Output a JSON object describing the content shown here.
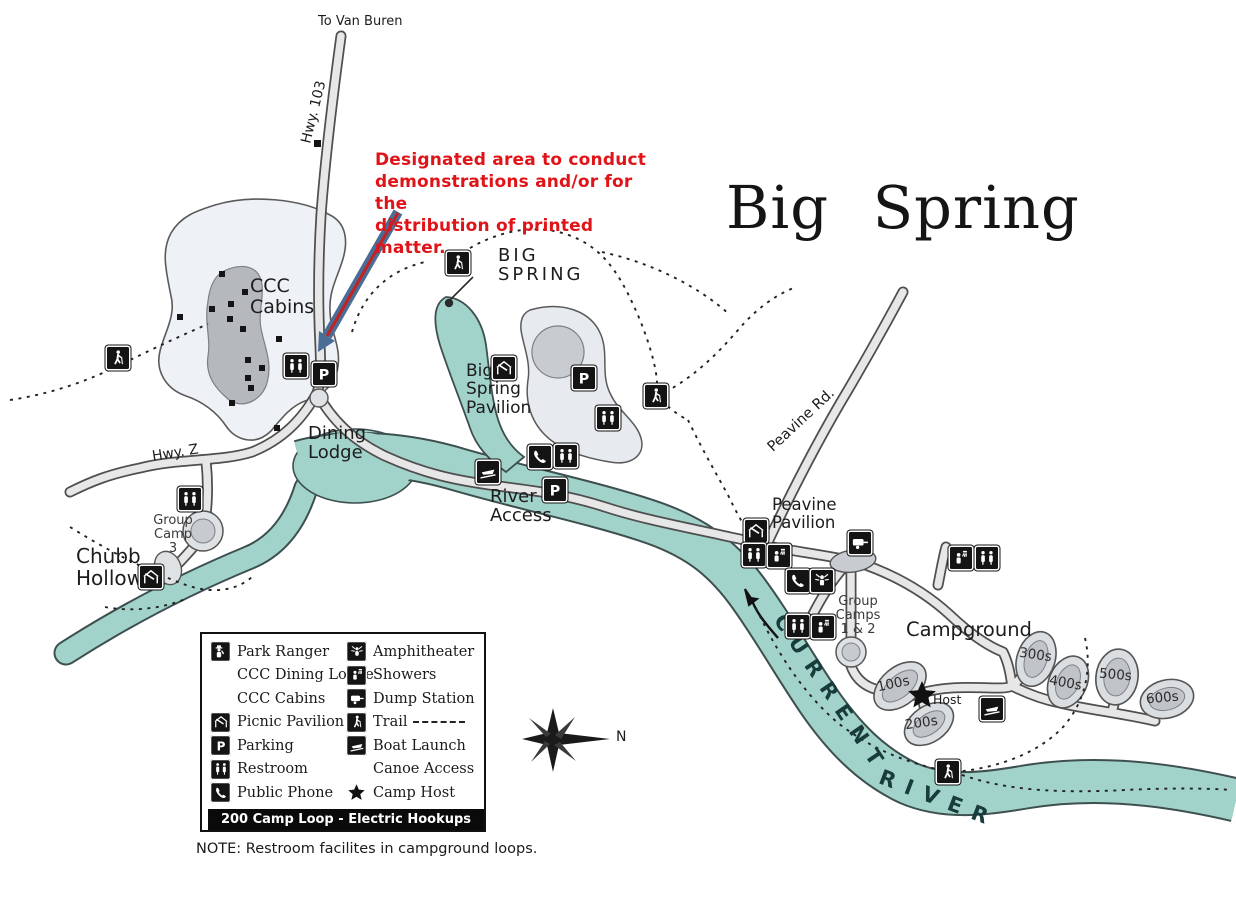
{
  "header": {
    "title": "Big Spring"
  },
  "annotation": {
    "text": "Designated area to conduct\ndemonstrations and/or for the\ndistribution of printed matter.",
    "color": "#e01418"
  },
  "colors": {
    "water": "#a2d3cb",
    "road_fill": "#e7e7e7",
    "annotation_red": "#e01418",
    "arrow_blue": "#4a6d96",
    "arrow_core_red": "#c42222"
  },
  "labels": {
    "to_van_buren": "To Van Buren",
    "hwy_103": "Hwy. 103",
    "ccc_cabins": "CCC\nCabins",
    "big_spring": "BIG\nSPRING",
    "big_spring_pavilion": "Big\nSpring\nPavilion",
    "dining_lodge": "Dining\nLodge",
    "river_access": "River\nAccess",
    "hwy_z": "Hwy. Z",
    "group_camp_3": "Group\nCamp\n3",
    "chubb_hollow": "Chubb\nHollow",
    "peavine_rd": "Peavine Rd.",
    "peavine_pavilion": "Peavine\nPavilion",
    "group_camps_1_2": "Group\nCamps\n1 & 2",
    "campground": "Campground",
    "host": "Host",
    "river_word_1": "CURRENT",
    "river_word_2": "RIVER"
  },
  "campground_loops": [
    "100s",
    "200s",
    "300s",
    "400s",
    "500s",
    "600s"
  ],
  "compass": {
    "north_label": "N"
  },
  "legend": {
    "left": [
      {
        "icon": "park-ranger",
        "label": "Park Ranger"
      },
      {
        "icon": null,
        "label": "CCC Dining Lodge"
      },
      {
        "icon": null,
        "label": "CCC Cabins"
      },
      {
        "icon": "picnic-pavilion",
        "label": "Picnic Pavilion"
      },
      {
        "icon": "parking",
        "label": "Parking"
      },
      {
        "icon": "restroom",
        "label": "Restroom"
      },
      {
        "icon": "public-phone",
        "label": "Public Phone"
      }
    ],
    "right": [
      {
        "icon": "amphitheater",
        "label": "Amphitheater"
      },
      {
        "icon": "showers",
        "label": "Showers"
      },
      {
        "icon": "dump-station",
        "label": "Dump Station"
      },
      {
        "icon": "trail",
        "label": "Trail"
      },
      {
        "icon": "boat-launch",
        "label": "Boat Launch"
      },
      {
        "icon": null,
        "label": "Canoe Access"
      },
      {
        "icon": "camp-host",
        "label": "Camp Host"
      }
    ],
    "footer": "200 Camp Loop - Electric Hookups",
    "note": "NOTE:  Restroom facilites in campground loops."
  }
}
